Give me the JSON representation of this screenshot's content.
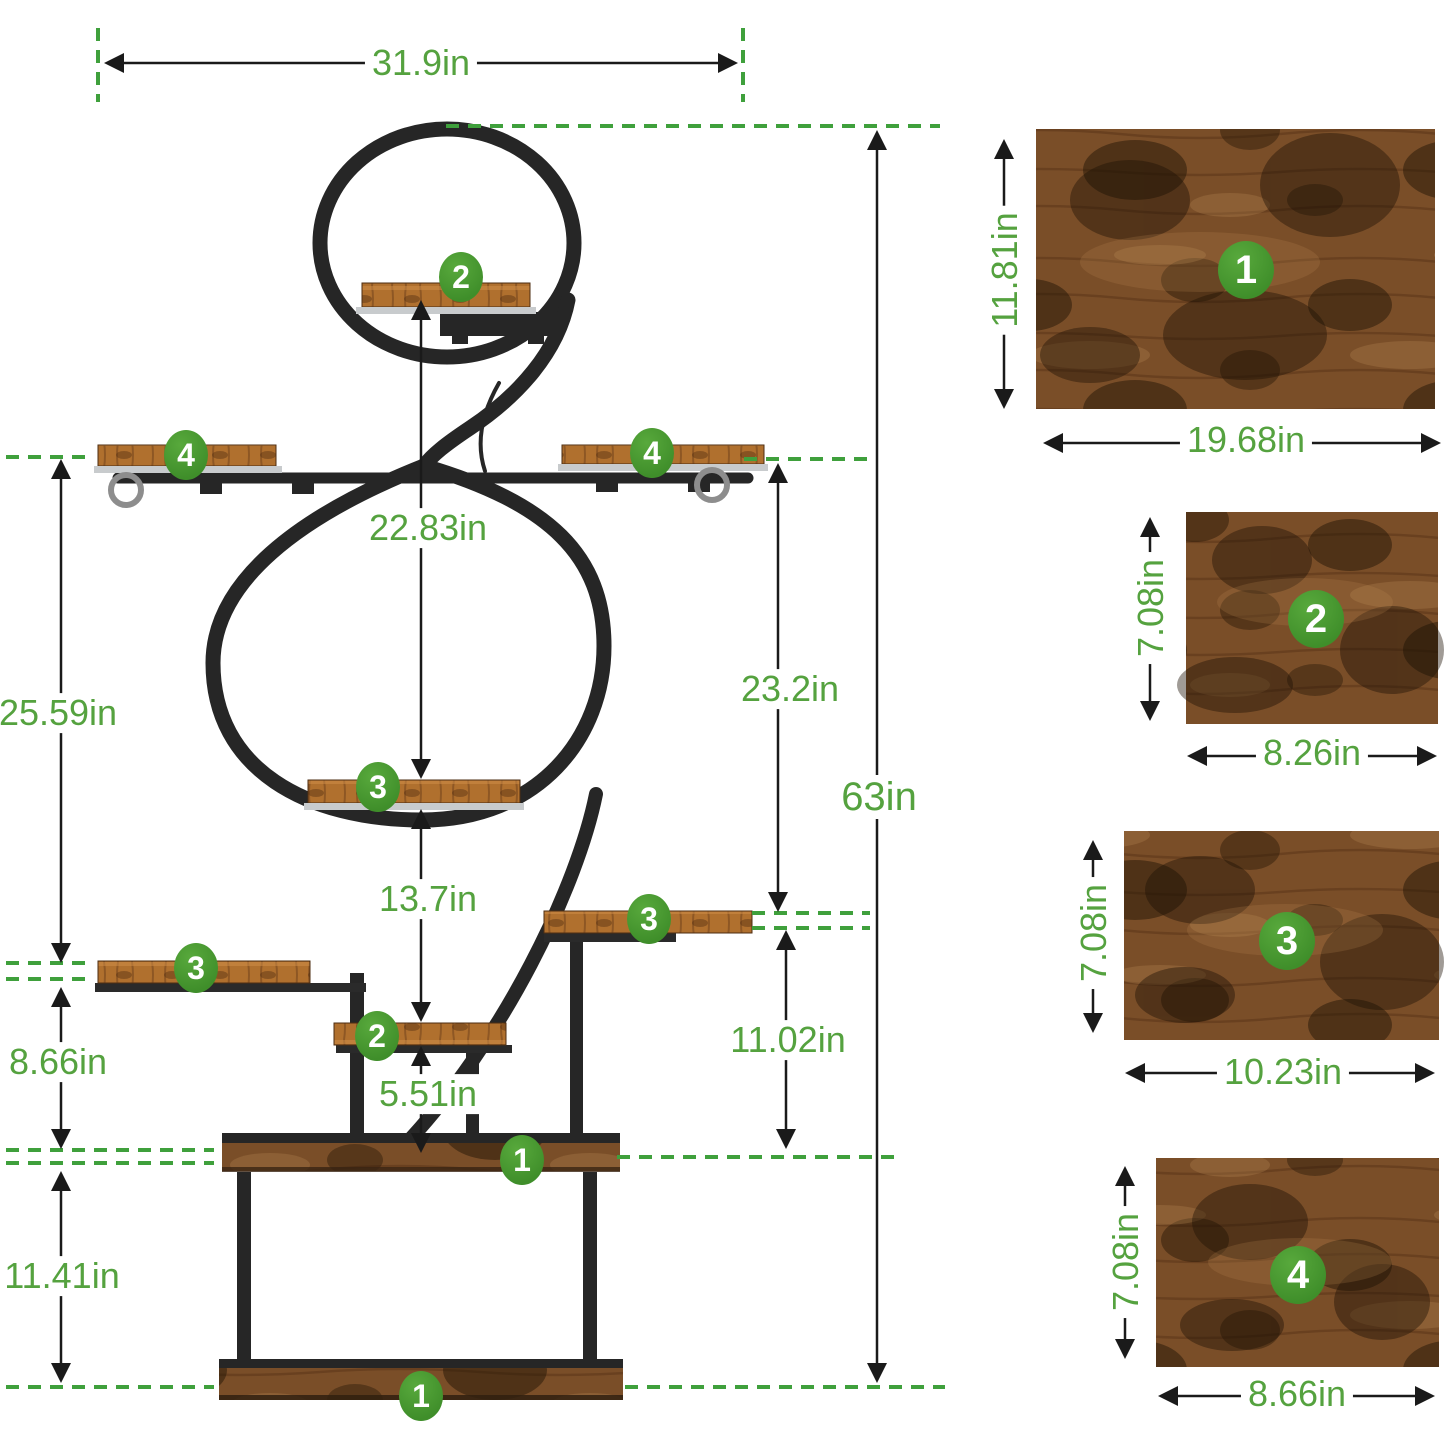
{
  "colors": {
    "dimension_text_green": "#55a23f",
    "dashed_guide_green": "#3fa03c",
    "badge_green": "#45942e",
    "frame_black": "#262626",
    "wood_brown": "#7a4e28",
    "plank_brown": "#b0702e",
    "silver_rail": "#c8cbcd"
  },
  "stand": {
    "dims": {
      "top_width": "31.9in",
      "shelf2_to_shelf3": "22.83in",
      "left_upper": "25.59in",
      "right_upper": "23.2in",
      "total_height": "63in",
      "shelf3_to_shelf2": "13.7in",
      "left_mid": "8.66in",
      "right_lower": "11.02in",
      "shelf2_to_base": "5.51in",
      "base_height": "11.41in"
    },
    "badges": [
      {
        "n": "2"
      },
      {
        "n": "4"
      },
      {
        "n": "4"
      },
      {
        "n": "3"
      },
      {
        "n": "3"
      },
      {
        "n": "3"
      },
      {
        "n": "2"
      },
      {
        "n": "1"
      },
      {
        "n": "1"
      }
    ]
  },
  "panels": [
    {
      "badge": "1",
      "width": "19.68in",
      "height": "11.81in"
    },
    {
      "badge": "2",
      "width": "8.26in",
      "height": "7.08in"
    },
    {
      "badge": "3",
      "width": "10.23in",
      "height": "7.08in"
    },
    {
      "badge": "4",
      "width": "8.66in",
      "height": "7.08in"
    }
  ]
}
